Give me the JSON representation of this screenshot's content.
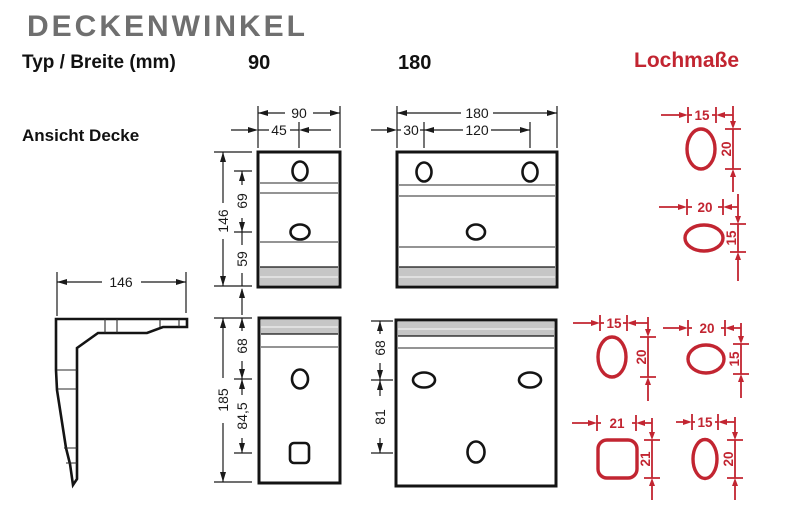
{
  "header": {
    "title": "DECKENWINKEL",
    "type_row_label": "Typ / Breite (mm)",
    "type_90": "90",
    "type_180": "180",
    "hole_dims_title": "Lochmaße"
  },
  "side_view": {
    "label": "Ansicht Decke",
    "depth": "146"
  },
  "ceiling_90": {
    "width": "90",
    "hole_offset_x": "45",
    "height": "146",
    "hole_pitch": "69",
    "hole_bottom": "59"
  },
  "ceiling_180": {
    "width": "180",
    "hole_offset_x": "30",
    "hole_pitch": "120"
  },
  "wall_90": {
    "height": "185",
    "hole_top": "68",
    "hole_pitch": "84,5"
  },
  "wall_180": {
    "hole_top": "68",
    "hole_pitch": "81"
  },
  "holes": [
    {
      "id": "ceiling-slot-vertical",
      "w": "15",
      "h": "20"
    },
    {
      "id": "ceiling-slot-horizontal",
      "w": "20",
      "h": "15"
    },
    {
      "id": "wall-slot-vertical",
      "w": "15",
      "h": "20"
    },
    {
      "id": "wall-slot-horizontal",
      "w": "20",
      "h": "15"
    },
    {
      "id": "wall-square-hole",
      "w": "21",
      "h": "21"
    },
    {
      "id": "wall-slot-vertical-2",
      "w": "15",
      "h": "20"
    }
  ],
  "colors": {
    "accent_red": "#c22531",
    "title_gray": "#6f6f6f",
    "plate_band_gray": "#c6c6c6",
    "line_black": "#141414"
  }
}
